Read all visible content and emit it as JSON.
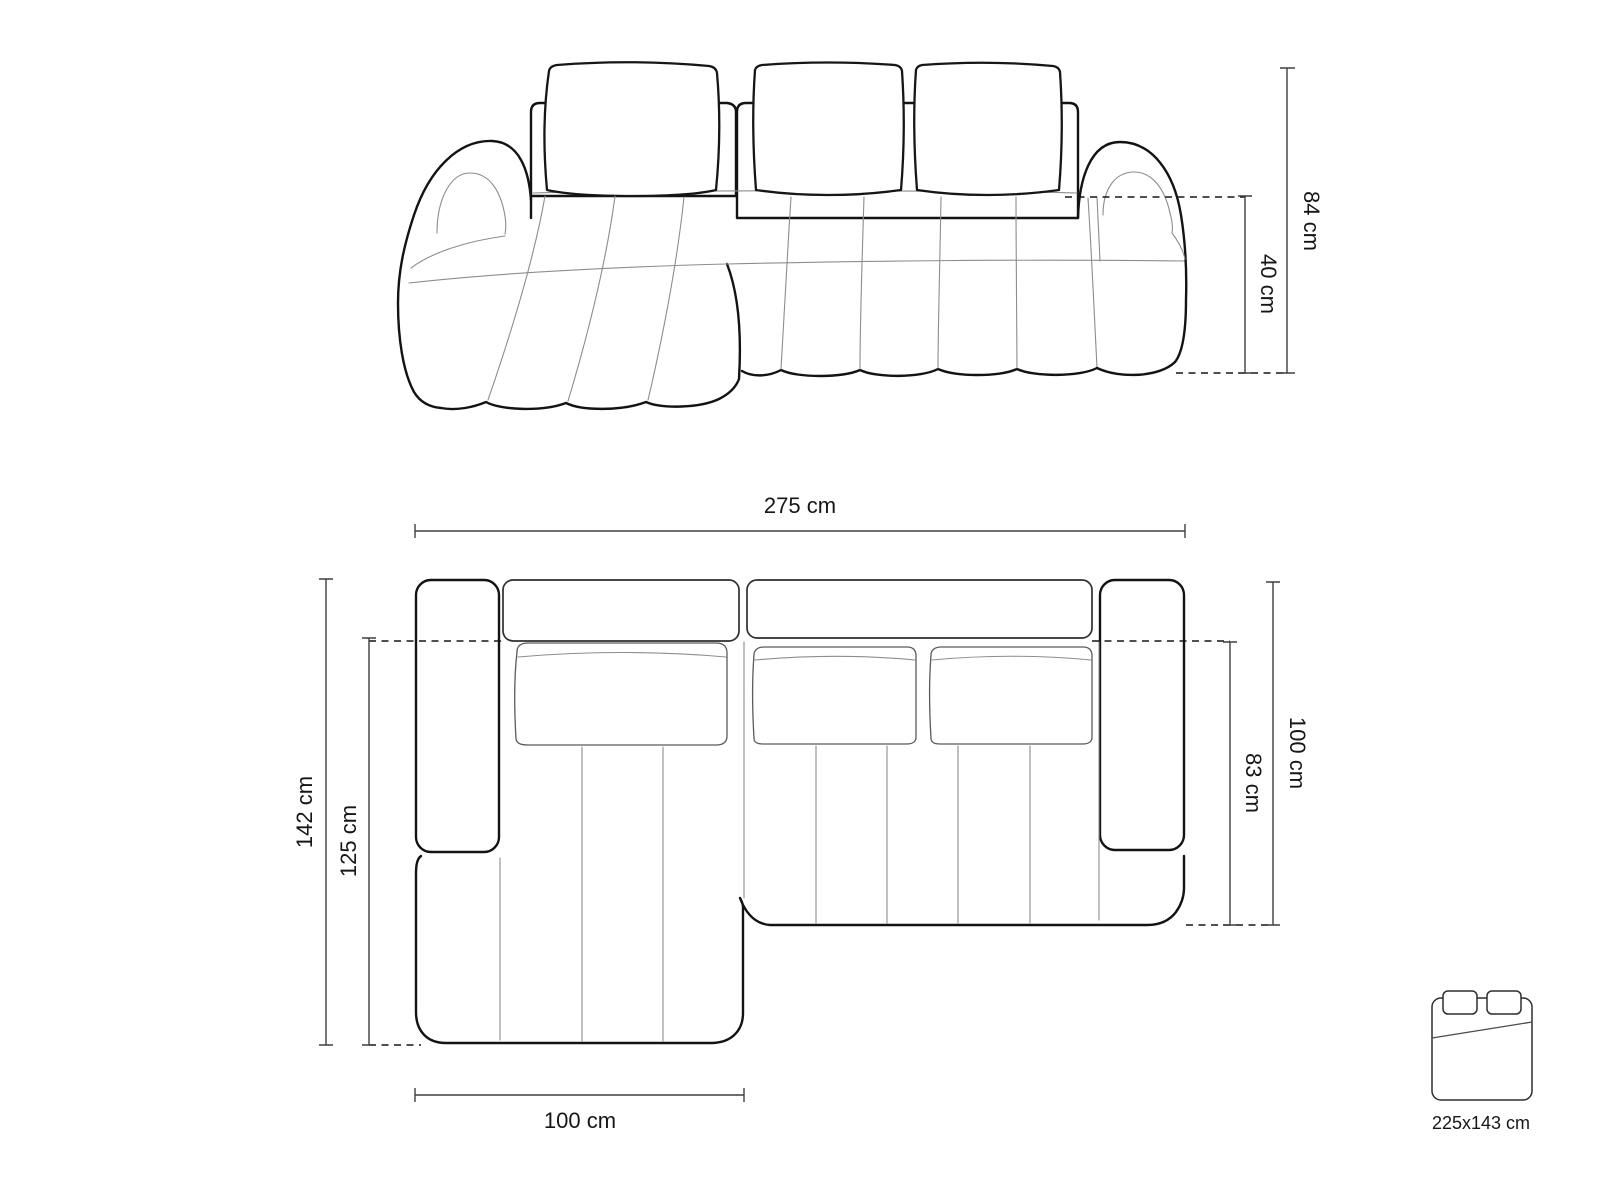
{
  "diagram_type": "sofa dimension drawing",
  "front_view": {
    "description": "corner sofa front elevation",
    "height_label": "84 cm",
    "seat_height_label": "40 cm"
  },
  "top_view": {
    "description": "corner sofa top plan",
    "width_label": "275 cm",
    "depth_label": "142 cm",
    "chaise_length_label": "125 cm",
    "side_depth_label": "100 cm",
    "seat_depth_label": "83 cm",
    "chaise_width_label": "100 cm"
  },
  "sleeping": {
    "icon": "bed-icon",
    "size_label": "225x143 cm"
  },
  "colors": {
    "background": "#ffffff",
    "outline": "#131313",
    "thin_line": "#8d8d8d",
    "dimension_line": "#3f3f3f",
    "text": "#161616"
  }
}
